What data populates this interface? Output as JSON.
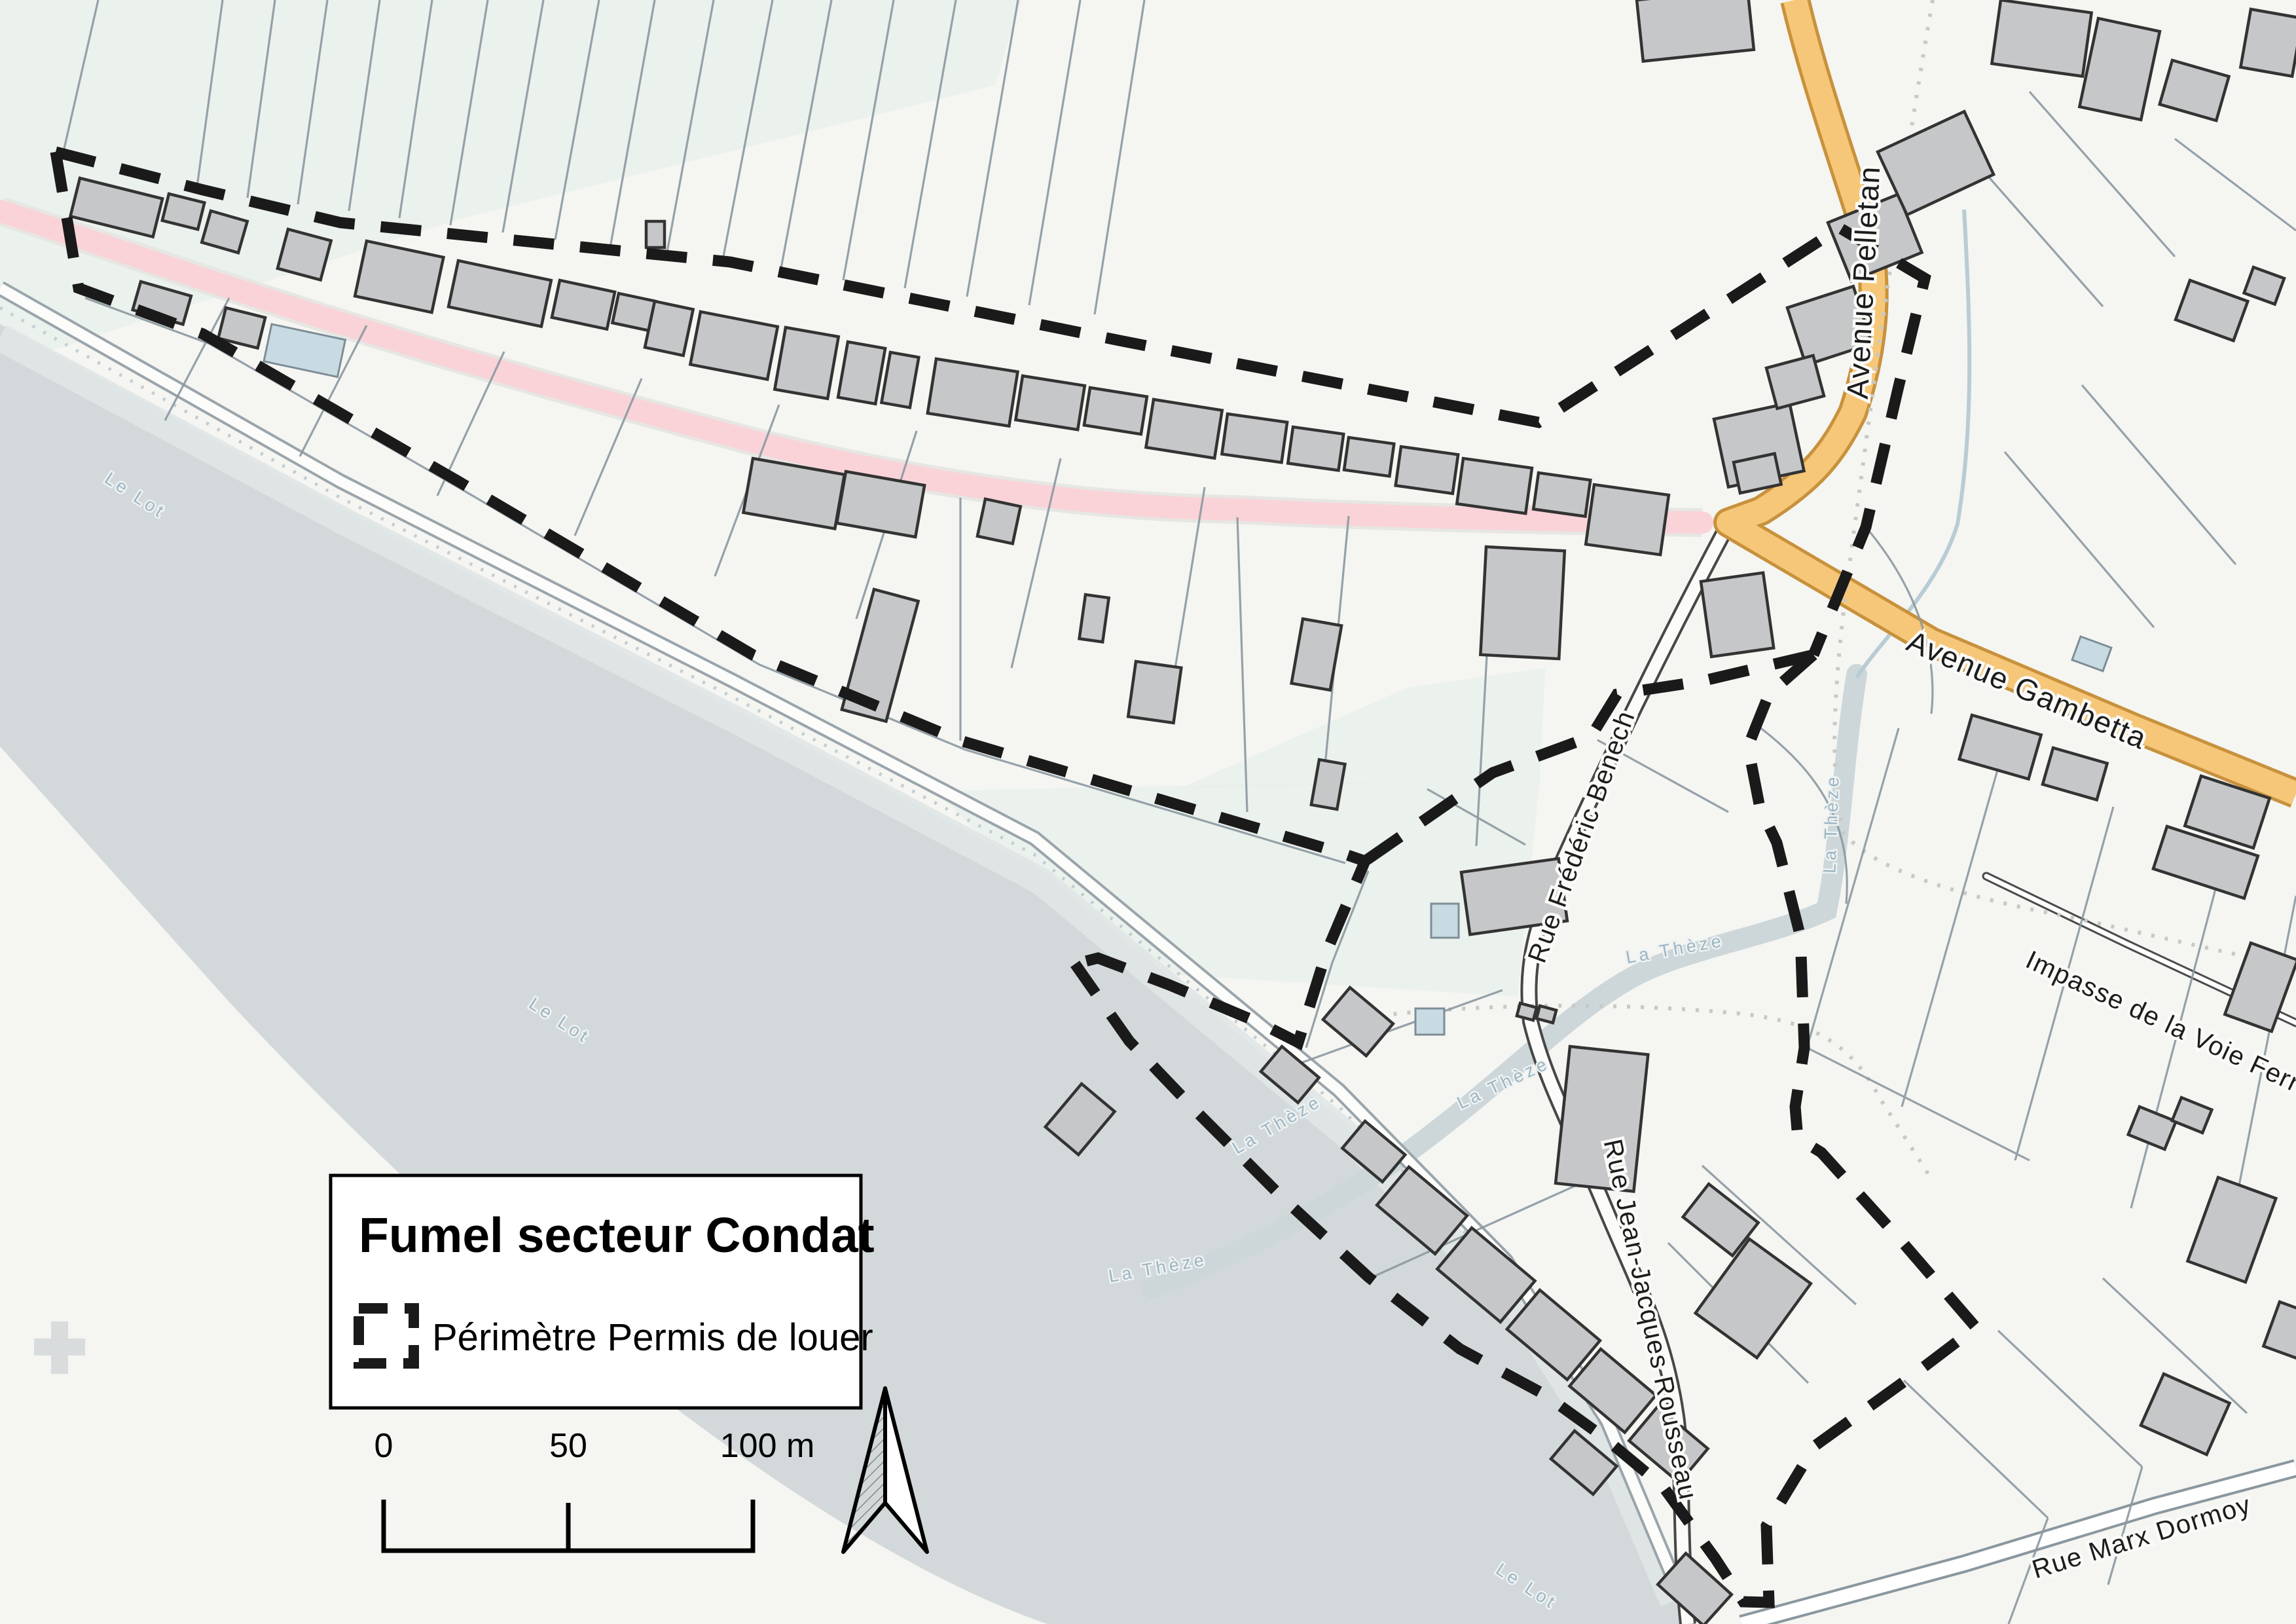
{
  "legend": {
    "title": "Fumel secteur Condat",
    "item_label": "Périmètre Permis de louer"
  },
  "scalebar": {
    "tick_0": "0",
    "tick_50": "50",
    "tick_100": "100 m"
  },
  "streets": {
    "pelletan": "Avenue Pelletan",
    "gambetta": "Avenue Gambetta",
    "benech": "Rue Frédéric Benech",
    "rousseau": "Rue Jean-Jacques Rousseau",
    "impasse": "Impasse de la Voie Ferrée",
    "dormoy": "Rue Marx Dormoy"
  },
  "water": {
    "river": "Le Lot",
    "stream": "La Thèze"
  },
  "colors": {
    "background": "#f5f5f2",
    "river": "#d3d9db",
    "river_bank": "#e0e5e6",
    "stream": "#cdd7da",
    "greenery": "#e9f0ea",
    "road_orange": "#f6c778",
    "road_orange_casing": "#c8913c",
    "road_pink": "#f9d3d8",
    "road_white": "#fcfcfa",
    "road_gray_casing": "#9aa5ab",
    "building": "#c6c7c8",
    "building_outline": "#333333",
    "parcel_line": "#8b98a0",
    "perimeter": "#1a1a1a",
    "water_label": "#9db5c0"
  }
}
